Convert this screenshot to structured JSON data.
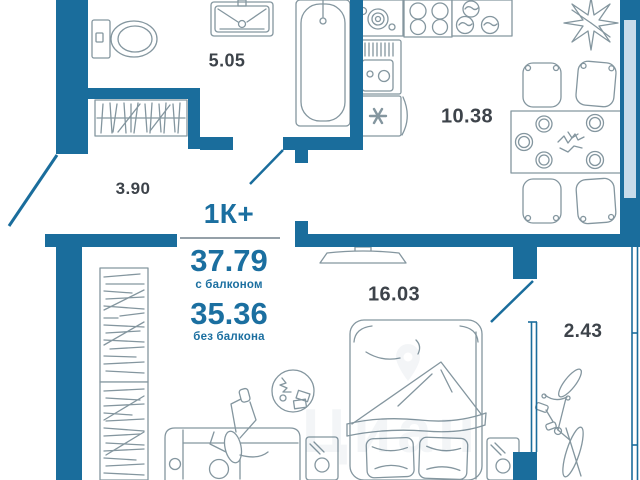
{
  "plan": {
    "title": "1К+",
    "summary": {
      "area_with_balcony": "37.79",
      "with_balcony_label": "с балконом",
      "area_without_balcony": "35.36",
      "without_balcony_label": "без балкона"
    },
    "rooms": [
      {
        "id": "bathroom",
        "area": "5.05"
      },
      {
        "id": "kitchen",
        "area": "10.38"
      },
      {
        "id": "hallway",
        "area": "3.90"
      },
      {
        "id": "living-room",
        "area": "16.03"
      },
      {
        "id": "balcony",
        "area": "2.43"
      }
    ],
    "watermark": "Циан",
    "colors": {
      "wall": "#1a6d9c",
      "window": "#c8dcea",
      "furniture_outline": "#84969f",
      "room_label": "#3d434a",
      "accent_text": "#1b6fa0"
    }
  }
}
